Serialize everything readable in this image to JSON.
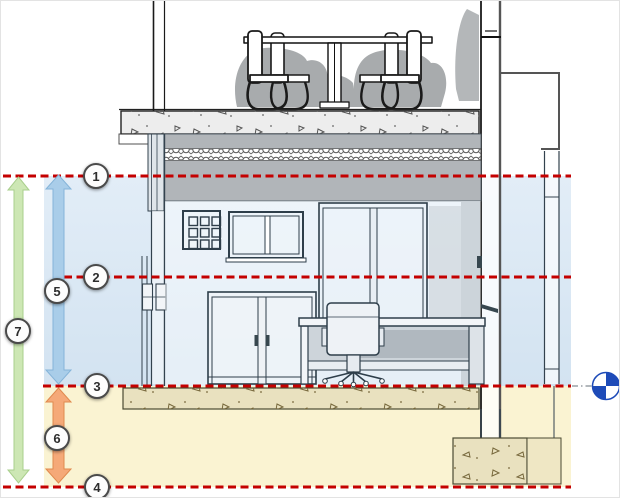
{
  "diagram": {
    "markers": [
      "1",
      "2",
      "3",
      "4",
      "5",
      "6",
      "7"
    ],
    "colors": {
      "level_line": "#c40000",
      "upper_zone": "#dae7f3",
      "lower_zone": "#faf3d2",
      "span_arrow_5": "#a9cde9",
      "span_arrow_6": "#f5a978",
      "span_arrow_7": "#cde7b4",
      "view_target": "#1e4bb8",
      "ceiling_band": "#b1b5b9"
    },
    "icons": {
      "view_target": "quartered-circle-marker"
    }
  }
}
